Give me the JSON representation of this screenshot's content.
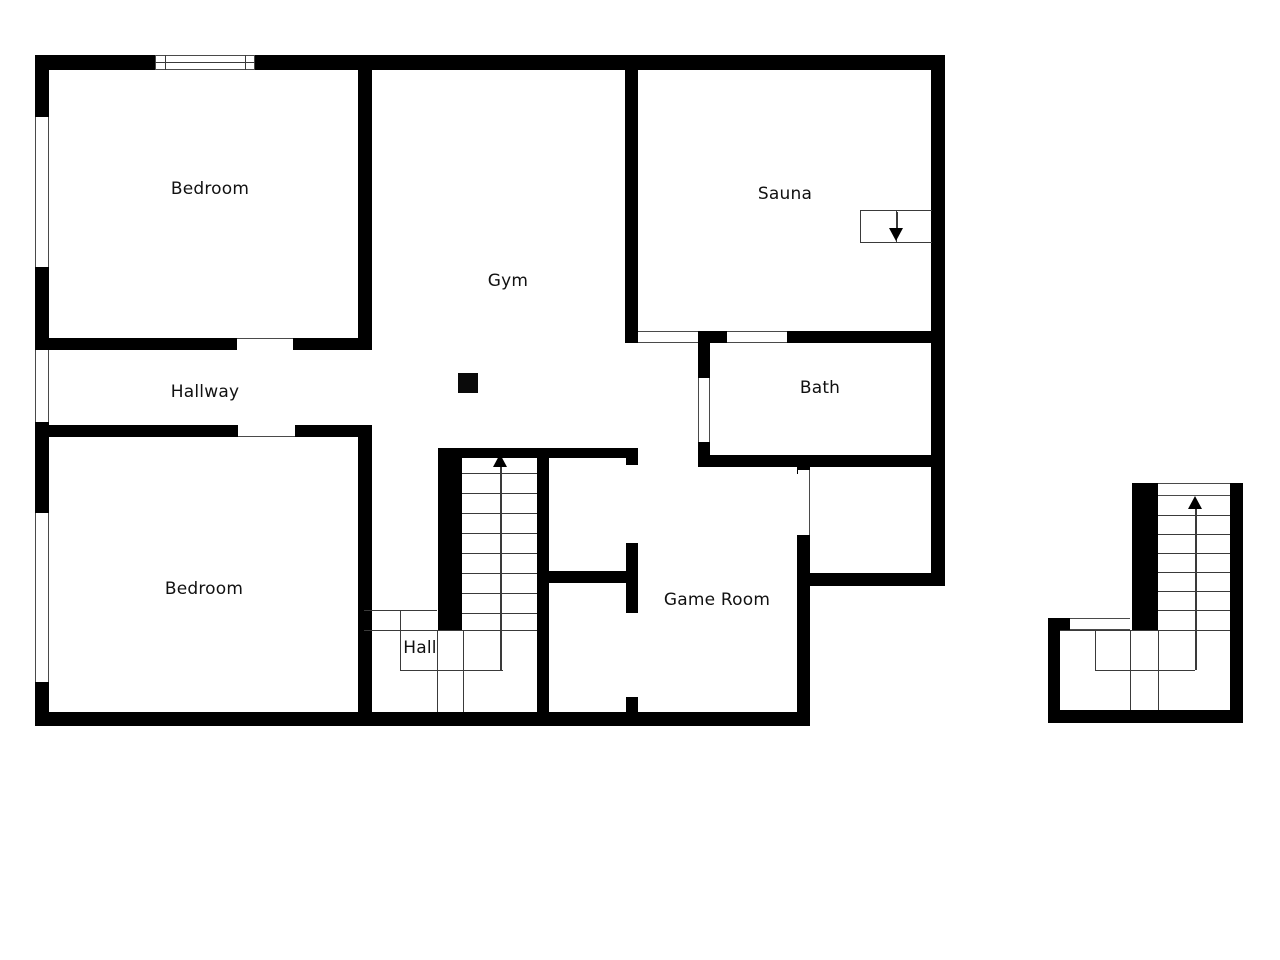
{
  "page": {
    "background": "#ffffff"
  },
  "floorplan": {
    "canvas": {
      "width": 1280,
      "height": 960,
      "wall_color": "#000000",
      "line_color": "#3a3a3a",
      "label_color": "#111111"
    },
    "rooms": [
      {
        "id": "bedroom-1",
        "label": "Bedroom",
        "x": 210,
        "y": 189
      },
      {
        "id": "sauna",
        "label": "Sauna",
        "x": 785,
        "y": 194
      },
      {
        "id": "gym",
        "label": "Gym",
        "x": 508,
        "y": 281
      },
      {
        "id": "hallway",
        "label": "Hallway",
        "x": 205,
        "y": 392
      },
      {
        "id": "bath",
        "label": "Bath",
        "x": 820,
        "y": 388
      },
      {
        "id": "bedroom-2",
        "label": "Bedroom",
        "x": 204,
        "y": 589
      },
      {
        "id": "hall",
        "label": "Hall",
        "x": 420,
        "y": 648
      },
      {
        "id": "game-room",
        "label": "Game Room",
        "x": 717,
        "y": 600
      }
    ],
    "walls": [
      [
        35,
        55,
        120,
        15
      ],
      [
        255,
        55,
        690,
        15
      ],
      [
        35,
        55,
        14,
        62
      ],
      [
        35,
        267,
        14,
        83
      ],
      [
        35,
        422,
        14,
        91
      ],
      [
        35,
        682,
        14,
        44
      ],
      [
        35,
        712,
        775,
        14
      ],
      [
        931,
        55,
        14,
        530
      ],
      [
        810,
        573,
        135,
        13
      ],
      [
        358,
        70,
        14,
        270
      ],
      [
        35,
        338,
        202,
        12
      ],
      [
        293,
        338,
        79,
        12
      ],
      [
        35,
        425,
        203,
        12
      ],
      [
        295,
        425,
        77,
        12
      ],
      [
        358,
        425,
        14,
        287
      ],
      [
        625,
        70,
        13,
        273
      ],
      [
        698,
        331,
        29,
        12
      ],
      [
        787,
        331,
        144,
        12
      ],
      [
        698,
        331,
        12,
        47
      ],
      [
        698,
        442,
        12,
        25
      ],
      [
        700,
        455,
        231,
        12
      ],
      [
        438,
        448,
        200,
        10
      ],
      [
        438,
        448,
        24,
        182
      ],
      [
        537,
        448,
        12,
        264
      ],
      [
        549,
        571,
        89,
        12
      ],
      [
        626,
        448,
        12,
        17
      ],
      [
        626,
        543,
        12,
        70
      ],
      [
        626,
        697,
        12,
        15
      ],
      [
        797,
        467,
        13,
        7
      ],
      [
        797,
        535,
        13,
        191
      ],
      [
        1048,
        618,
        12,
        105
      ],
      [
        1048,
        618,
        22,
        12
      ],
      [
        1132,
        483,
        26,
        147
      ],
      [
        1230,
        483,
        13,
        240
      ],
      [
        1048,
        710,
        195,
        13
      ]
    ],
    "windows": [
      {
        "rect": [
          155,
          55,
          100,
          15
        ],
        "sides": [
          "top",
          "bottom",
          "left",
          "right"
        ]
      },
      {
        "rect": [
          35,
          117,
          14,
          150
        ],
        "sides": [
          "left",
          "right"
        ]
      },
      {
        "rect": [
          35,
          350,
          14,
          72
        ],
        "sides": [
          "left",
          "right"
        ]
      },
      {
        "rect": [
          35,
          513,
          14,
          169
        ],
        "sides": [
          "left",
          "right"
        ]
      },
      {
        "rect": [
          1158,
          483,
          72,
          13
        ],
        "sides": [
          "top",
          "bottom"
        ]
      },
      {
        "rect": [
          1070,
          618,
          60,
          12
        ],
        "sides": [
          "top",
          "bottom"
        ]
      }
    ],
    "openings": [
      {
        "rect": [
          237,
          338,
          56,
          12
        ],
        "sides": [
          "top"
        ]
      },
      {
        "rect": [
          238,
          425,
          57,
          12
        ],
        "sides": [
          "bottom"
        ]
      },
      {
        "rect": [
          638,
          331,
          60,
          12
        ],
        "sides": [
          "top",
          "bottom"
        ]
      },
      {
        "rect": [
          727,
          331,
          60,
          12
        ],
        "sides": [
          "top",
          "bottom"
        ]
      },
      {
        "rect": [
          698,
          378,
          12,
          64
        ],
        "sides": [
          "left",
          "right"
        ]
      },
      {
        "rect": [
          798,
          470,
          12,
          65
        ],
        "sides": [
          "right"
        ]
      }
    ],
    "staircases": [
      {
        "id": "hall-staircase",
        "x1": 462,
        "x2": 537,
        "y_start": 473,
        "step": 20,
        "treads": 8
      },
      {
        "id": "entry-staircase",
        "x1": 1158,
        "x2": 1230,
        "y_start": 515,
        "step": 19,
        "treads": 6
      }
    ],
    "thin_lines": [
      [
        364,
        610,
        437,
        610
      ],
      [
        400,
        610,
        400,
        670
      ],
      [
        364,
        630,
        537,
        630
      ],
      [
        400,
        670,
        503,
        670
      ],
      [
        437,
        630,
        437,
        712
      ],
      [
        463,
        630,
        463,
        712
      ],
      [
        1060,
        630,
        1230,
        630
      ],
      [
        1130,
        630,
        1130,
        710
      ],
      [
        1158,
        630,
        1158,
        710
      ],
      [
        1095,
        630,
        1095,
        670
      ],
      [
        1095,
        670,
        1195,
        670
      ],
      [
        860,
        210,
        932,
        210
      ],
      [
        860,
        242,
        932,
        242
      ],
      [
        860,
        210,
        860,
        242
      ],
      [
        896,
        210,
        896,
        242
      ],
      [
        155,
        62,
        255,
        62
      ],
      [
        165,
        55,
        165,
        70
      ],
      [
        245,
        55,
        245,
        70
      ]
    ],
    "arrows": [
      {
        "id": "hall-stairs-up-arrow",
        "shaft": [
          500,
          466,
          500,
          670
        ],
        "head_x": 500,
        "head_y": 454,
        "dir": "up"
      },
      {
        "id": "entry-stairs-up-arrow",
        "shaft": [
          1195,
          508,
          1195,
          670
        ],
        "head_x": 1195,
        "head_y": 496,
        "dir": "up"
      },
      {
        "id": "sauna-steps-down-arrow",
        "shaft": [
          896,
          212,
          896,
          229
        ],
        "head_x": 896,
        "head_y": 241,
        "dir": "down"
      }
    ],
    "columns": [
      {
        "id": "gym-column",
        "rect": [
          458,
          373,
          20,
          20
        ]
      }
    ]
  }
}
